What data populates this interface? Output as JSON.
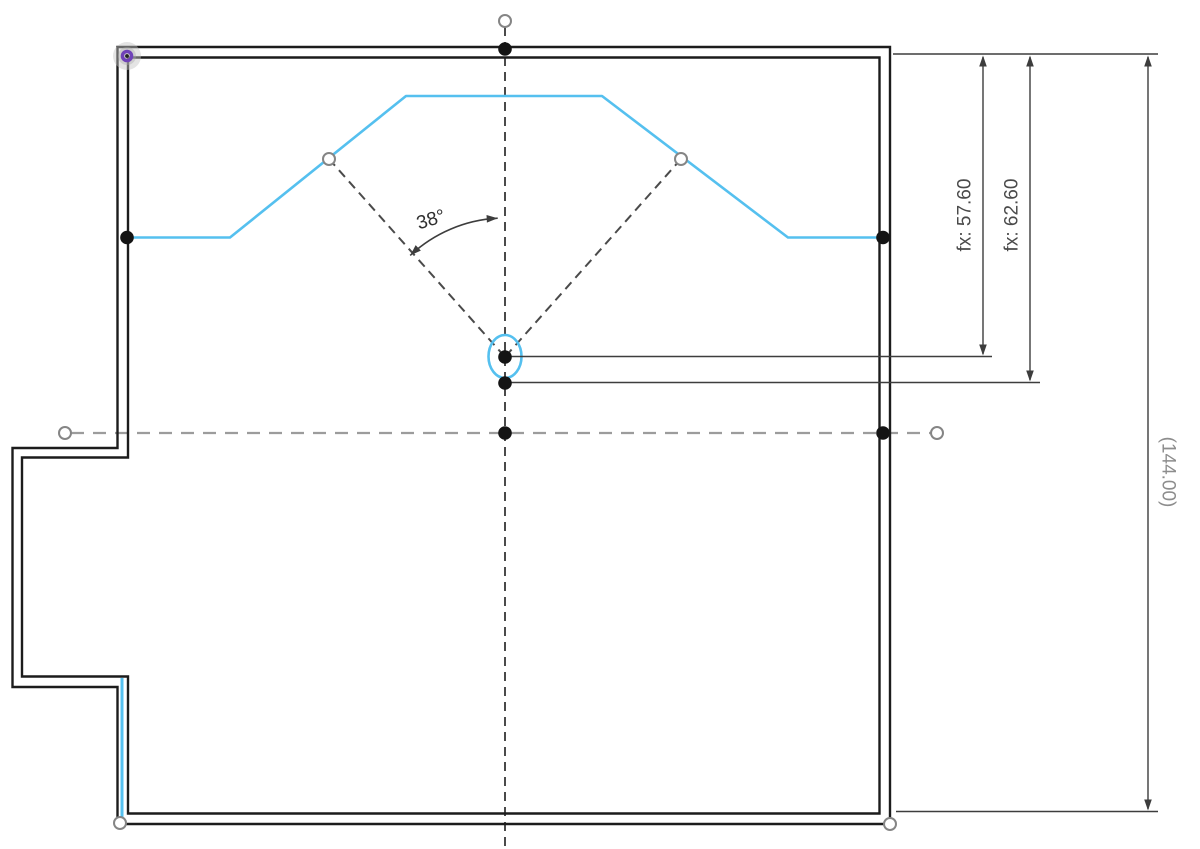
{
  "app": {
    "description": "CAD sketch canvas with dimensioned wall outline",
    "background": "#ffffff"
  },
  "colors": {
    "wall": "#1c1c1c",
    "sketch_blue": "#55c0ef",
    "construction_dark": "#4a4a4a",
    "construction_light": "#9c9c9c",
    "dimension_line": "#3d3d3d",
    "fx_text": "#4a4a4a",
    "ref_text": "#8d8d8d",
    "angle_text": "#2e2e2e",
    "origin_purple": "#6f42b8",
    "point_fill": "#141414",
    "open_point_stroke": "#858585"
  },
  "walls": {
    "stroke_width": 2.4,
    "outer": [
      [
        117.5,
        47
      ],
      [
        890,
        47
      ],
      [
        890,
        824
      ],
      [
        117.5,
        824
      ],
      [
        117.5,
        687
      ],
      [
        12.5,
        687
      ],
      [
        12.5,
        448
      ],
      [
        117.5,
        448
      ]
    ],
    "inner": [
      [
        128,
        57.5
      ],
      [
        879.5,
        57.5
      ],
      [
        879.5,
        813.5
      ],
      [
        128,
        813.5
      ],
      [
        128,
        676.5
      ],
      [
        22,
        676.5
      ],
      [
        22,
        457.5
      ],
      [
        128,
        457.5
      ]
    ]
  },
  "sketch": {
    "stroke_width": 2.6,
    "profile_points": [
      [
        128,
        237.5
      ],
      [
        230,
        237.5
      ],
      [
        406,
        96
      ],
      [
        602,
        96
      ],
      [
        788,
        237.5
      ],
      [
        881,
        237.5
      ]
    ],
    "left_segment": [
      [
        122,
        678
      ],
      [
        122,
        822
      ]
    ],
    "ellipse": {
      "cx": 505,
      "cy": 356.5,
      "rx": 16.5,
      "ry": 21.5
    }
  },
  "construction": {
    "dark_dash": "9 6",
    "light_dash": "13 9",
    "vertical_centerline": [
      [
        505,
        27
      ],
      [
        505,
        849
      ]
    ],
    "diagonal_left": [
      [
        329,
        159
      ],
      [
        505,
        357
      ]
    ],
    "diagonal_right": [
      [
        681,
        159
      ],
      [
        505,
        357
      ]
    ],
    "horizontal_centerline": [
      [
        71,
        433
      ],
      [
        931,
        433
      ]
    ]
  },
  "points": {
    "filled_radius": 6.8,
    "open_radius": 6,
    "filled": [
      [
        505,
        49
      ],
      [
        127,
        237.5
      ],
      [
        883,
        237.5
      ],
      [
        505,
        357
      ],
      [
        505,
        383
      ],
      [
        505,
        433
      ],
      [
        883,
        433
      ]
    ],
    "open": [
      [
        505,
        21
      ],
      [
        65,
        433
      ],
      [
        937,
        433
      ],
      [
        329,
        159
      ],
      [
        681,
        159
      ],
      [
        120,
        823
      ],
      [
        890,
        824
      ]
    ],
    "origin": {
      "x": 127,
      "y": 56
    }
  },
  "dimensions": {
    "extension_lines": [
      [
        [
          893,
          54
        ],
        [
          1158,
          54
        ]
      ],
      [
        [
          511,
          356.5
        ],
        [
          992,
          356.5
        ]
      ],
      [
        [
          511,
          382.5
        ],
        [
          1040,
          382.5
        ]
      ],
      [
        [
          896,
          811.5
        ],
        [
          1158,
          811.5
        ]
      ]
    ],
    "linear": [
      {
        "id": "57-60",
        "label": "fx: 57.60",
        "x": 983,
        "y1": 57,
        "y2": 354,
        "tx": 965,
        "ty": 215,
        "rotation": -90,
        "color": "#4a4a4a"
      },
      {
        "id": "62-60",
        "label": "fx: 62.60",
        "x": 1030,
        "y1": 57,
        "y2": 380,
        "tx": 1012,
        "ty": 215,
        "rotation": -90,
        "color": "#4a4a4a"
      },
      {
        "id": "144-00",
        "label": "(144.00)",
        "x": 1148,
        "y1": 57,
        "y2": 809,
        "tx": 1168,
        "ty": 472,
        "rotation": 90,
        "color": "#8d8d8d"
      }
    ],
    "angular": {
      "label": "38°",
      "arc": "M 410.2 255.4 A 139 139 0 0 1 497.7 218.2",
      "tx": 431,
      "ty": 220,
      "rotation": -17,
      "arrows": [
        {
          "x": 410.2,
          "y": 255.4,
          "angle": 137
        },
        {
          "x": 497.7,
          "y": 218.2,
          "angle": -3
        }
      ]
    }
  }
}
